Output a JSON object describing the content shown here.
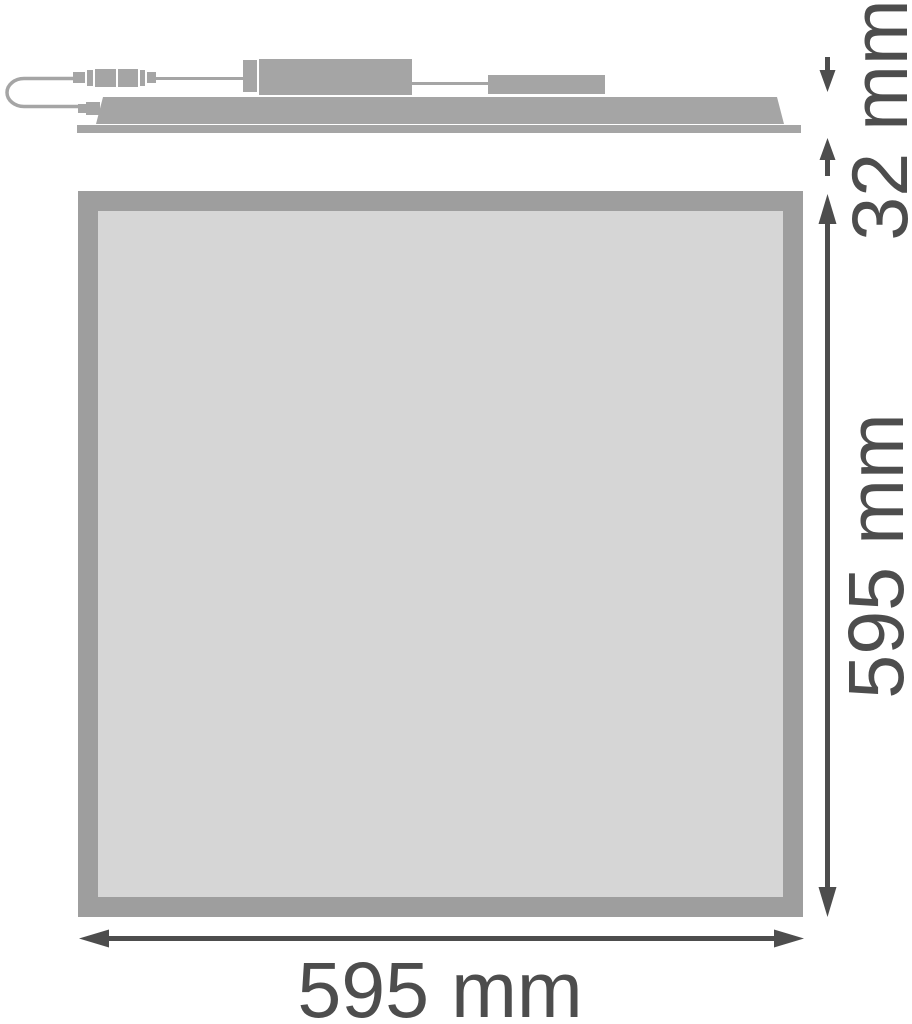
{
  "labels": {
    "depth": "32 mm",
    "height": "595 mm",
    "width": "595 mm"
  },
  "colors": {
    "outline-gray": "#a5a5a5",
    "panel-border-gray": "#9e9e9e",
    "panel-face-gray": "#d6d6d6",
    "dimension-dark": "#4d4d4d",
    "background": "#ffffff"
  }
}
